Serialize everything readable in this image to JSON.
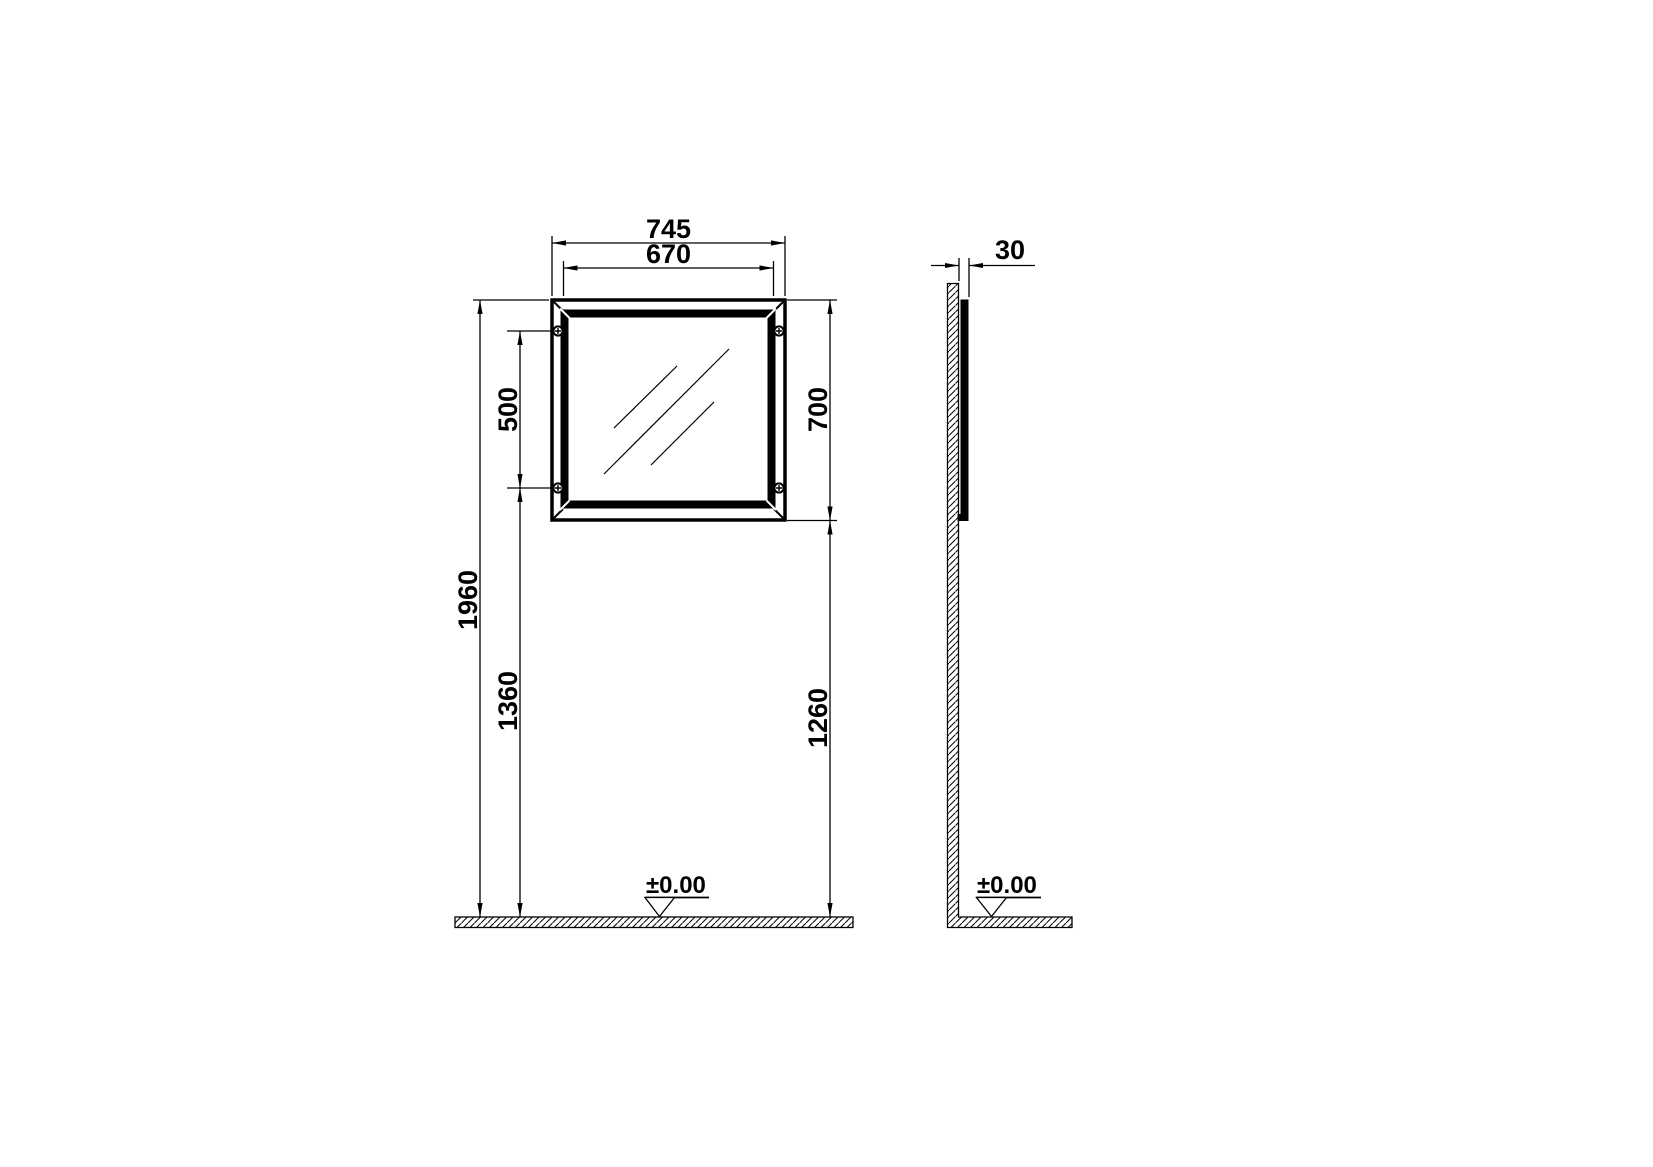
{
  "colors": {
    "line": "#000000",
    "background": "#ffffff"
  },
  "dimensions": {
    "front": {
      "width_outer": "745",
      "width_inner": "670",
      "hole_spacing": "500",
      "height_outer": "700",
      "height_total": "1960",
      "holes_to_floor": "1360",
      "bottom_to_floor": "1260",
      "floor_level": "±0.00"
    },
    "side": {
      "depth": "30",
      "floor_level": "±0.00"
    }
  }
}
